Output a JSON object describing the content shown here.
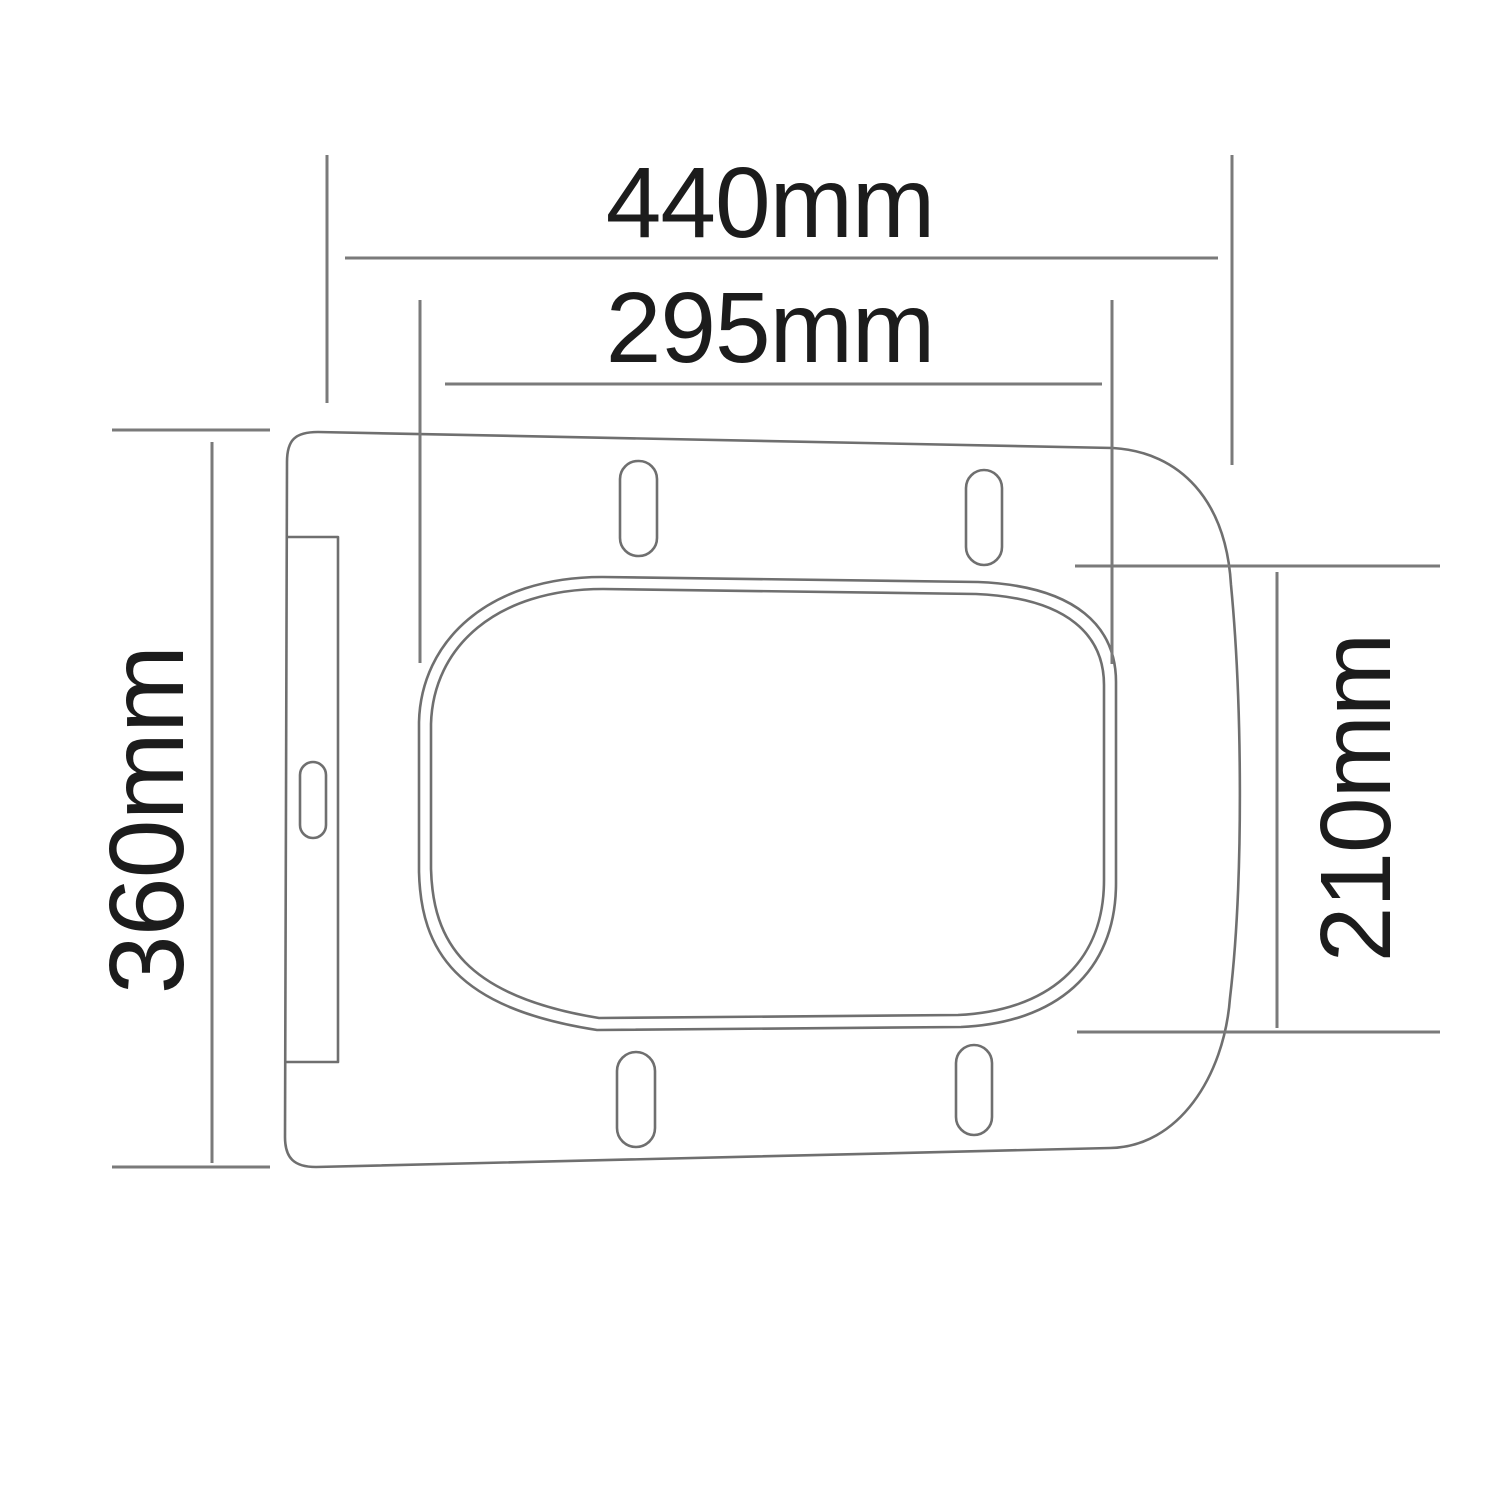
{
  "diagram": {
    "labels": {
      "outer_width": "440mm",
      "inner_width": "295mm",
      "outer_depth": "360mm",
      "inner_depth": "210mm"
    },
    "measurements_mm": {
      "outer_width": 440,
      "inner_width": 295,
      "outer_depth": 360,
      "inner_depth": 210
    },
    "colors": {
      "background": "#ffffff",
      "outline": "#6f6f6f",
      "dimension_line": "#7a7a7a",
      "label_text": "#1c1c1c"
    }
  }
}
